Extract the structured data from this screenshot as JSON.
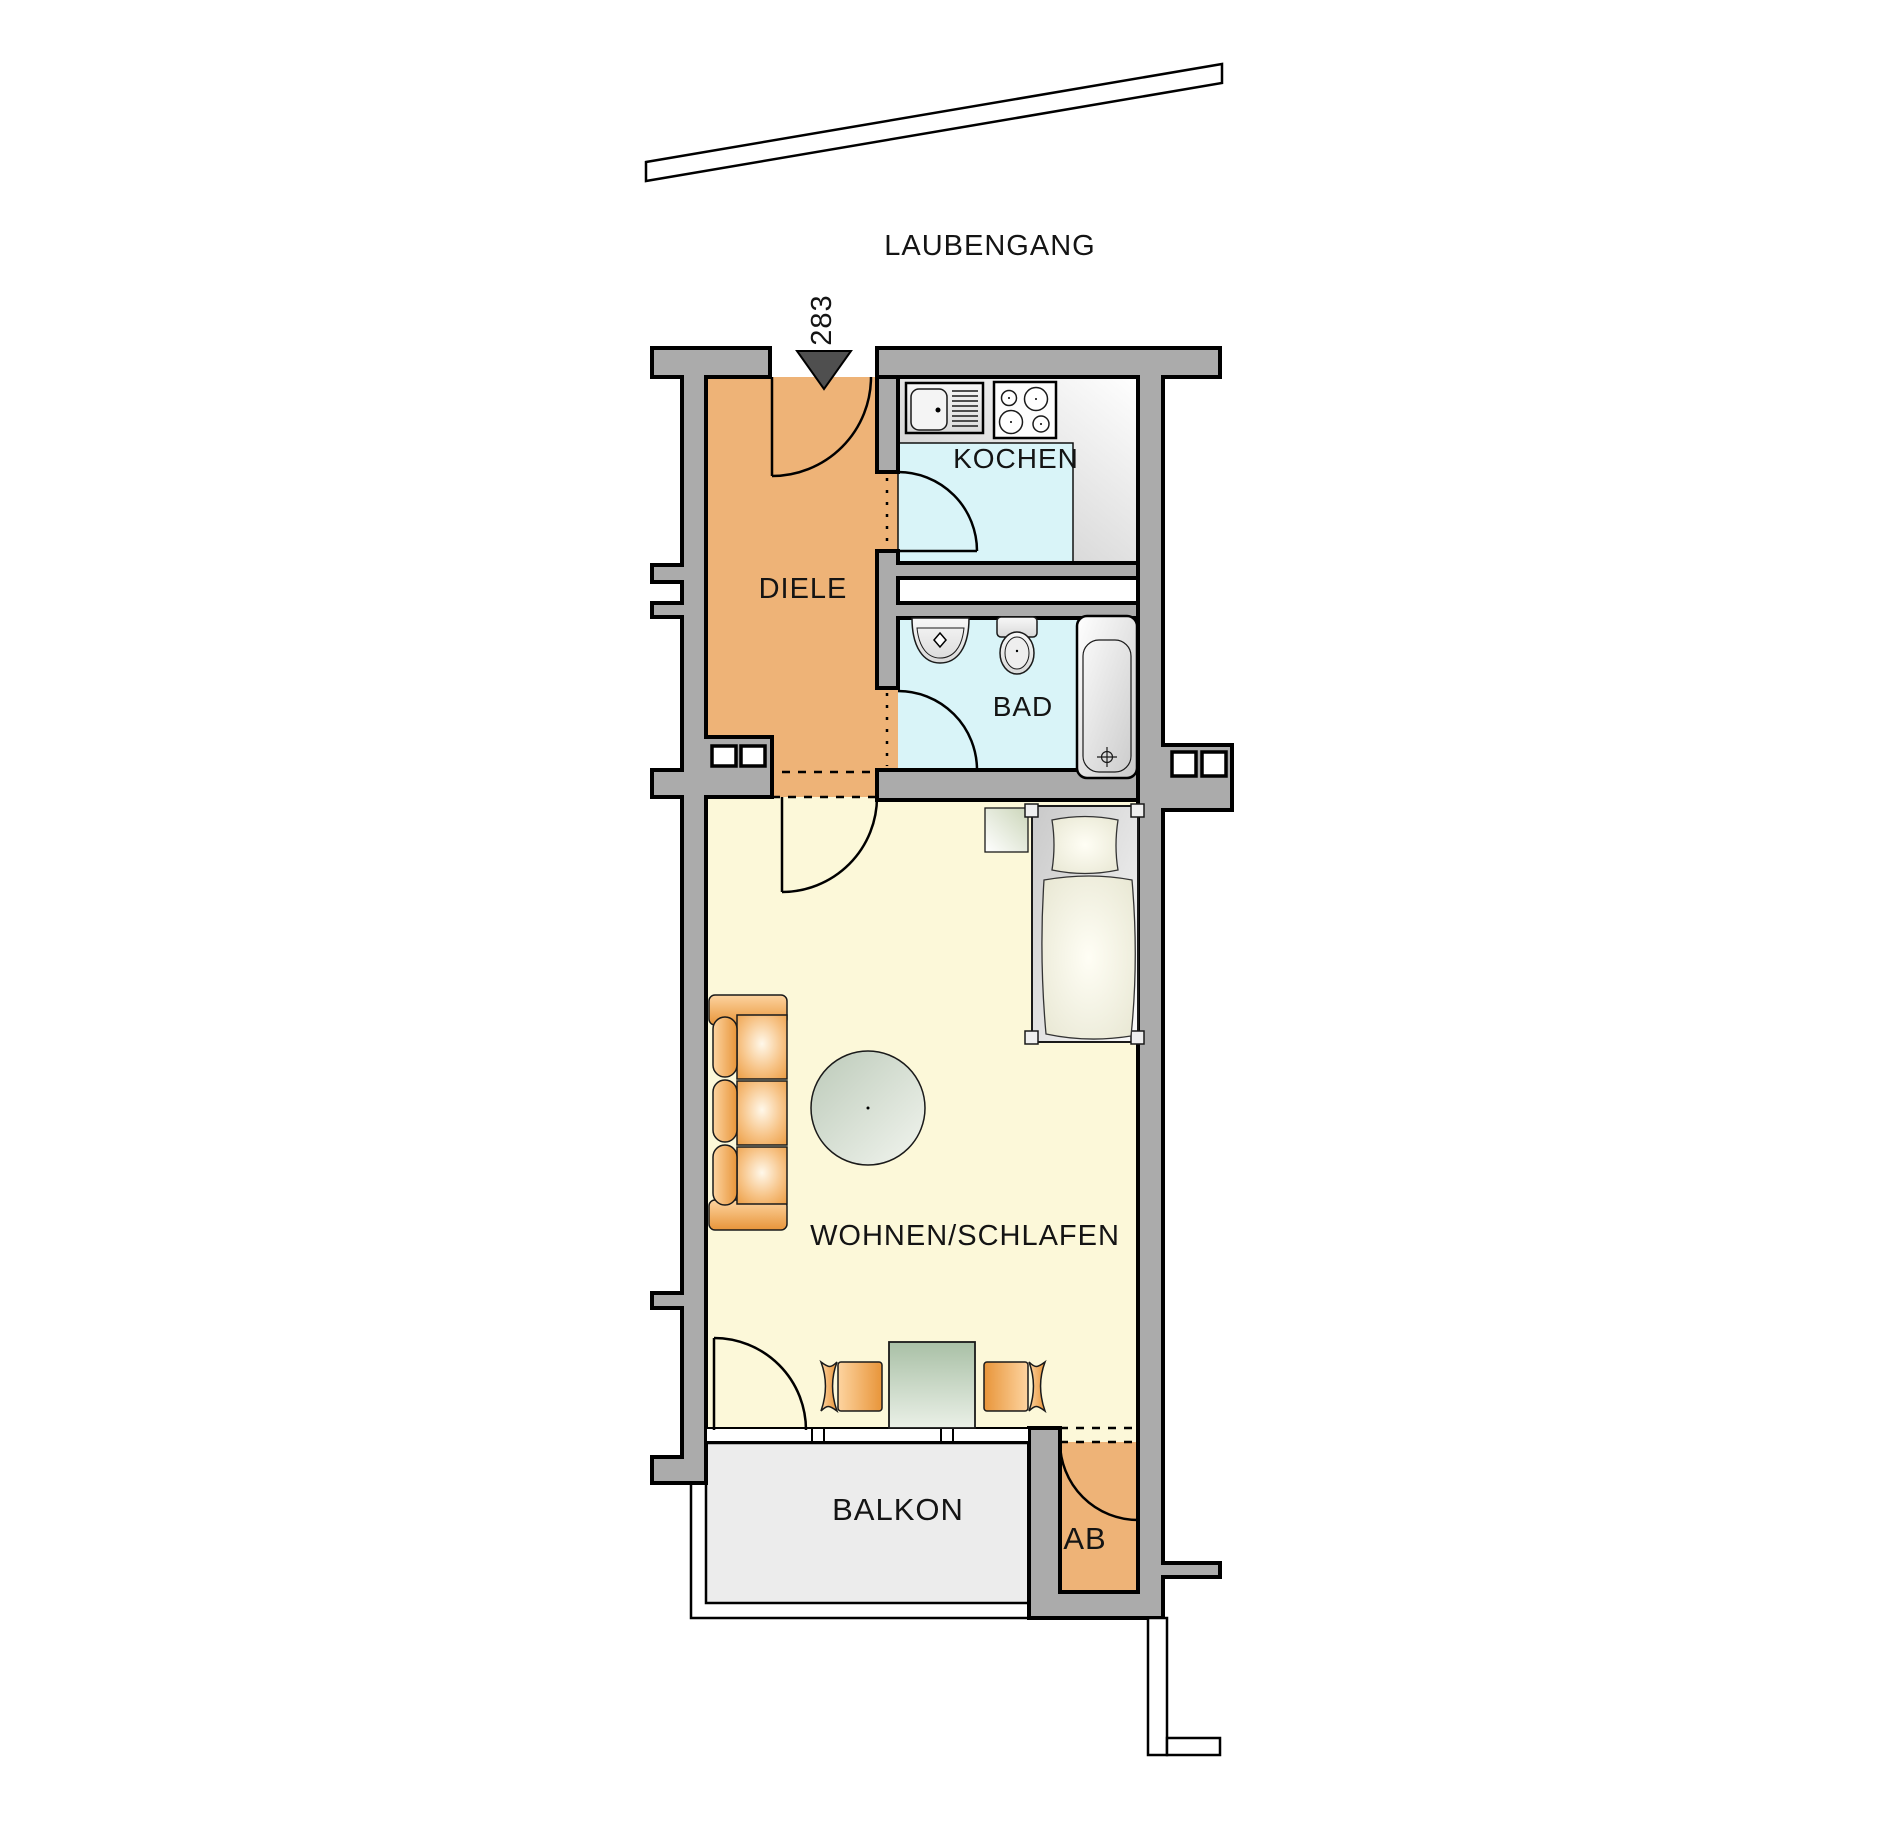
{
  "title": "apartment-floor-plan",
  "palette": {
    "wall": "#ababab",
    "outline": "#000000",
    "diele": "#eeb377",
    "wet": "#d9f4f8",
    "wohnen": "#fcf8d9",
    "balkon": "#ececec",
    "ab": "#eeb377",
    "marker": "#4f4f4f"
  },
  "labels": {
    "laubengang": "LAUBENGANG",
    "entry_number": "283",
    "kochen": "KOCHEN",
    "diele": "DIELE",
    "bad": "BAD",
    "wohnen": "WOHNEN/SCHLAFEN",
    "balkon": "BALKON",
    "ab": "AB"
  }
}
